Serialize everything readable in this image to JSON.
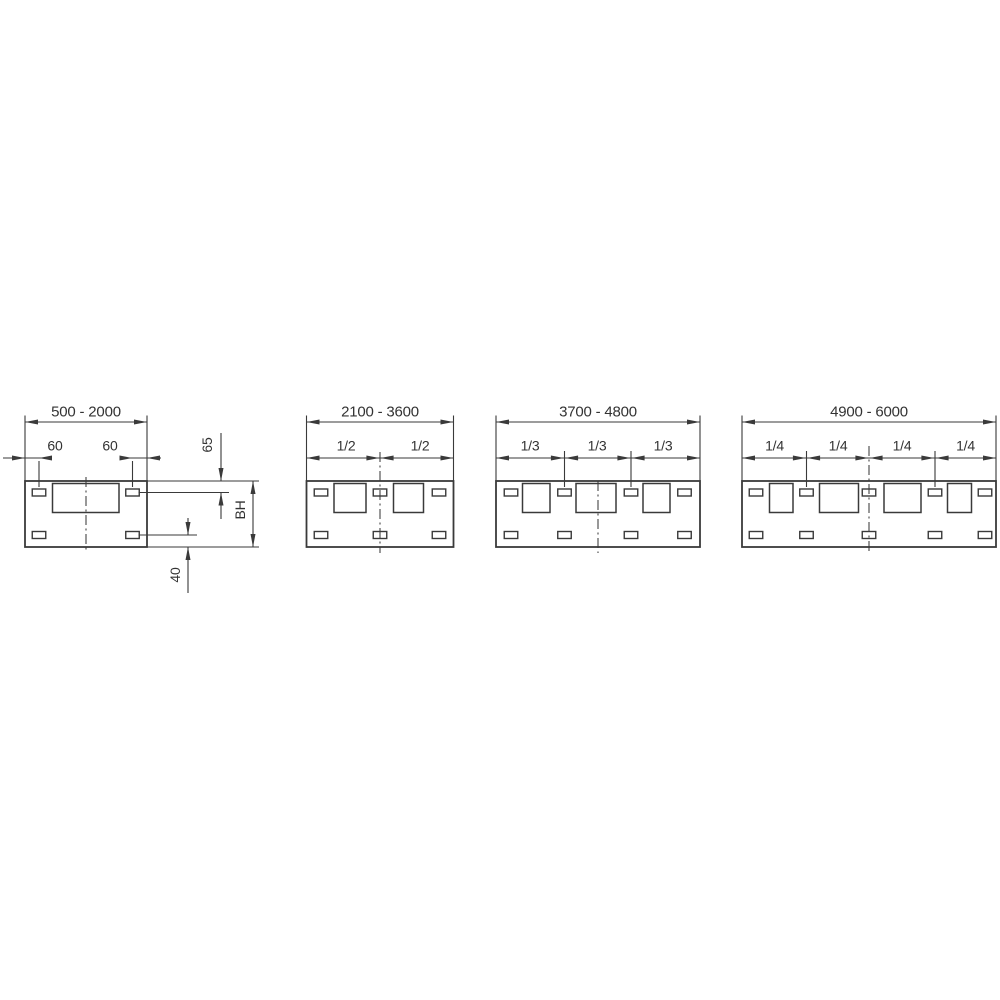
{
  "diagram": {
    "line_color": "#3a3a3a",
    "text_color": "#333333",
    "background": "#ffffff",
    "panels": [
      {
        "name": "panel-500-2000",
        "label": "500 - 2000",
        "x1": 25,
        "x2": 147,
        "squares": [
          [
            52.5,
            66.5
          ]
        ],
        "slots": [
          39,
          132.5
        ],
        "center_x": 86,
        "center_top": 477,
        "fractions": [],
        "splits": [],
        "frac_label_x": [],
        "offset_dims": [
          {
            "label": "60",
            "a": 25,
            "b": 39,
            "label_x": 55,
            "line_from": 3,
            "line_to": 52
          },
          {
            "label": "60",
            "a": 132.5,
            "b": 147,
            "label_x": 110,
            "line_from": 119.5,
            "line_to": 161
          }
        ],
        "side_dims": {
          "top": "65",
          "height": "BH",
          "bottom": "40"
        }
      },
      {
        "name": "panel-2100-3600",
        "label": "2100 - 3600",
        "x1": 306.5,
        "x2": 453.5,
        "squares": [
          [
            334,
            32
          ],
          [
            393.5,
            30
          ]
        ],
        "slots": [
          321,
          380,
          439
        ],
        "center_x": 380,
        "center_top": 452,
        "fractions": [
          "1/2",
          "1/2"
        ],
        "splits": [
          380
        ],
        "frac_label_x": [
          346,
          420
        ],
        "offset_dims": []
      },
      {
        "name": "panel-3700-4800",
        "label": "3700 - 4800",
        "x1": 496,
        "x2": 700,
        "squares": [
          [
            522.5,
            27.5
          ],
          [
            576,
            40
          ],
          [
            643,
            27
          ]
        ],
        "slots": [
          511,
          564.5,
          631,
          684.5
        ],
        "center_x": 598,
        "center_top": 481,
        "fractions": [
          "1/3",
          "1/3",
          "1/3"
        ],
        "splits": [
          564.5,
          631
        ],
        "frac_label_x": [
          530,
          597,
          663
        ],
        "offset_dims": []
      },
      {
        "name": "panel-4900-6000",
        "label": "4900 - 6000",
        "x1": 742,
        "x2": 996,
        "squares": [
          [
            769.5,
            23.5
          ],
          [
            819.5,
            39
          ],
          [
            884,
            37
          ],
          [
            947.5,
            24
          ]
        ],
        "slots": [
          756,
          806.5,
          869,
          935,
          985
        ],
        "center_x": 869,
        "center_top": 446,
        "fractions": [
          "1/4",
          "1/4",
          "1/4",
          "1/4"
        ],
        "splits": [
          806.5,
          869,
          935
        ],
        "frac_label_x": [
          774.5,
          838,
          902,
          965.5
        ],
        "offset_dims": []
      }
    ]
  }
}
